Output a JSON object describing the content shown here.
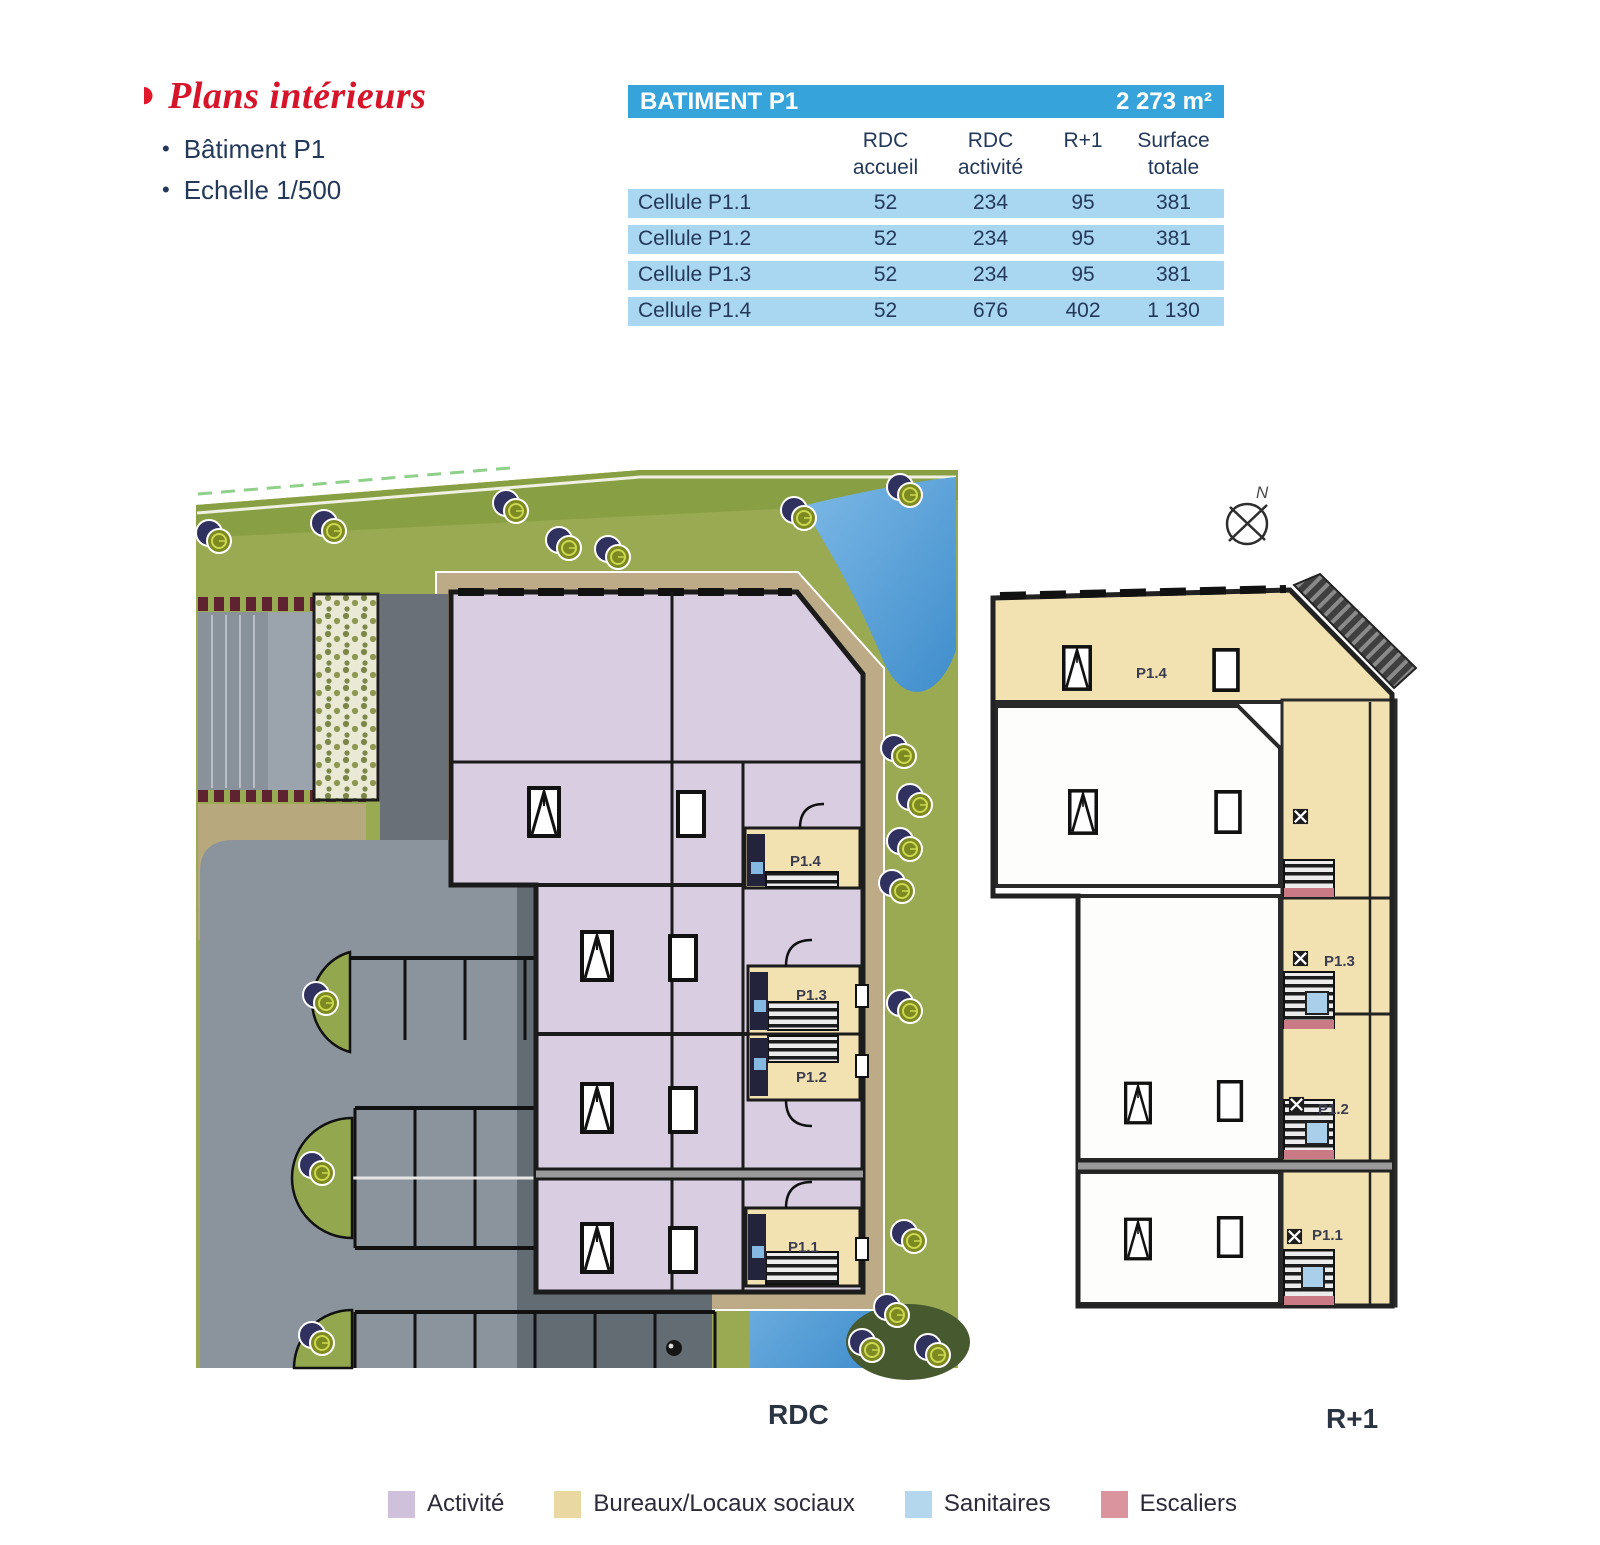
{
  "page": {
    "background": "#ffffff"
  },
  "title": {
    "arrow_icon": "◗",
    "text": "Plans intérieurs",
    "bullets": [
      "Bâtiment P1",
      "Echelle 1/500"
    ]
  },
  "table": {
    "header": {
      "title": "BATIMENT P1",
      "total_surface": "2 273 m²"
    },
    "columns": [
      {
        "line1": "RDC",
        "line2": "accueil"
      },
      {
        "line1": "RDC",
        "line2": "activité"
      },
      {
        "line1": "R+1",
        "line2": ""
      },
      {
        "line1": "Surface",
        "line2": "totale"
      }
    ],
    "rows": [
      {
        "label": "Cellule P1.1",
        "values": [
          "52",
          "234",
          "95",
          "381"
        ]
      },
      {
        "label": "Cellule P1.2",
        "values": [
          "52",
          "234",
          "95",
          "381"
        ]
      },
      {
        "label": "Cellule P1.3",
        "values": [
          "52",
          "234",
          "95",
          "381"
        ]
      },
      {
        "label": "Cellule P1.4",
        "values": [
          "52",
          "676",
          "402",
          "1 130"
        ]
      }
    ]
  },
  "plans": {
    "north_label": "N",
    "rdc": {
      "label": "RDC",
      "cells": {
        "p14": "P1.4",
        "p13": "P1.3",
        "p12": "P1.2",
        "p11": "P1.1"
      }
    },
    "r1": {
      "label": "R+1",
      "cells": {
        "p14": "P1.4",
        "p13": "P1.3",
        "p12": "P1.2",
        "p11": "P1.1"
      }
    }
  },
  "legend": {
    "items": [
      {
        "label": "Activité",
        "color": "#cfc1dc"
      },
      {
        "label": "Bureaux/Locaux sociaux",
        "color": "#e9d8a1"
      },
      {
        "label": "Sanitaires",
        "color": "#b5d7ee"
      },
      {
        "label": "Escaliers",
        "color": "#d9949e"
      }
    ]
  },
  "colors": {
    "accent_red": "#d6152b",
    "navy_text": "#24395a",
    "table_header_blue": "#36a4da",
    "table_row_blue": "#a9d6f0",
    "activity_purple": "#d9cde2",
    "offices_tan": "#f2e2b2",
    "sanitary_blue": "#a9cfea",
    "stairs_pink": "#c97a84",
    "wall_dark": "#1b1b1b",
    "grass_green": "#9aaa52",
    "pond_blue": "#58a3d8",
    "asphalt_dark": "#636b73",
    "asphalt_light": "#8b939c",
    "walkway_tan": "#bcab86"
  }
}
